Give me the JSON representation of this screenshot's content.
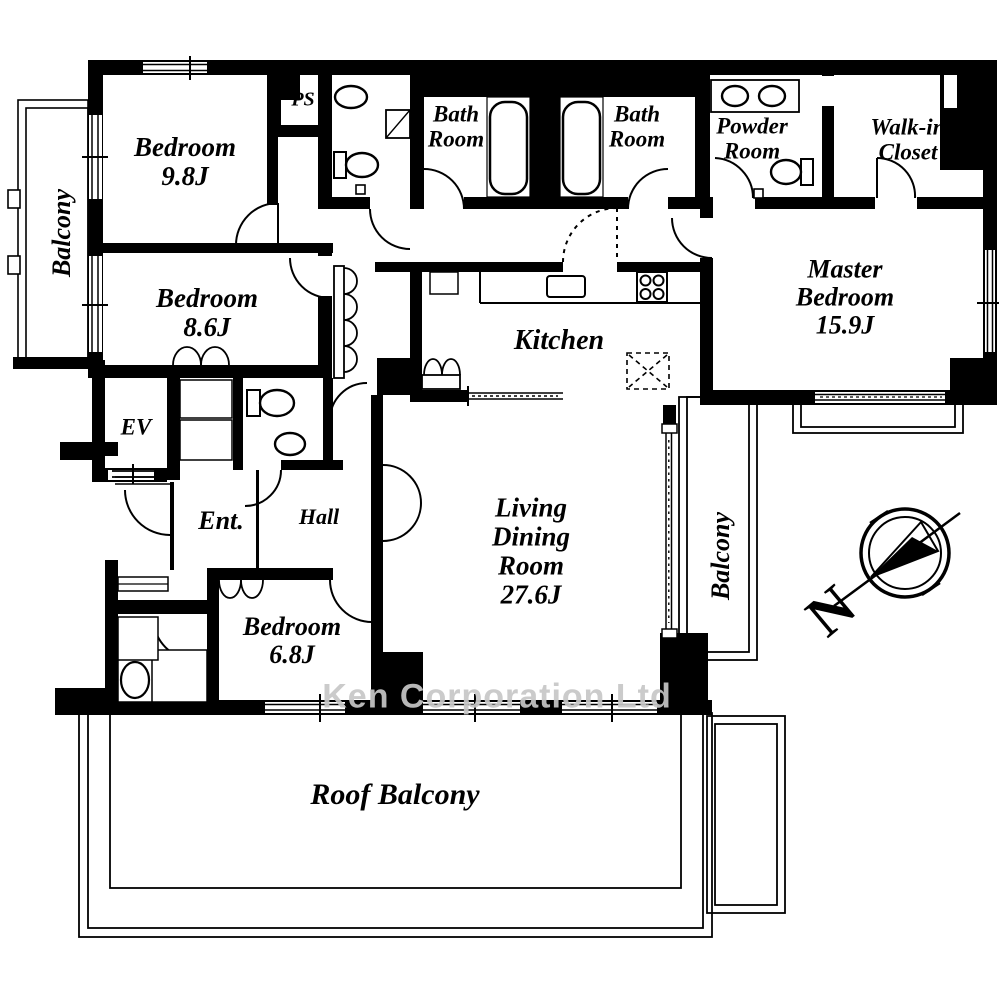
{
  "watermark": "Ken Corporation Ltd",
  "compass": {
    "north_label": "N"
  },
  "rooms": {
    "balcony_left": {
      "label": "Balcony"
    },
    "bedroom_98": {
      "label": "Bedroom",
      "size": "9.8J"
    },
    "bedroom_86": {
      "label": "Bedroom",
      "size": "8.6J"
    },
    "ps": {
      "label": "PS"
    },
    "bath_left": {
      "l1": "Bath",
      "l2": "Room"
    },
    "bath_right": {
      "l1": "Bath",
      "l2": "Room"
    },
    "powder": {
      "l1": "Powder",
      "l2": "Room"
    },
    "walkin": {
      "l1": "Walk-in",
      "l2": "Closet"
    },
    "master": {
      "l1": "Master",
      "l2": "Bedroom",
      "size": "15.9J"
    },
    "kitchen": {
      "label": "Kitchen"
    },
    "ev": {
      "label": "EV"
    },
    "ent": {
      "label": "Ent."
    },
    "hall": {
      "label": "Hall"
    },
    "ldr": {
      "l1": "Living",
      "l2": "Dining",
      "l3": "Room",
      "size": "27.6J"
    },
    "balcony_right": {
      "label": "Balcony"
    },
    "bedroom_68": {
      "label": "Bedroom",
      "size": "6.8J"
    },
    "roof_balcony": {
      "label": "Roof Balcony"
    }
  }
}
